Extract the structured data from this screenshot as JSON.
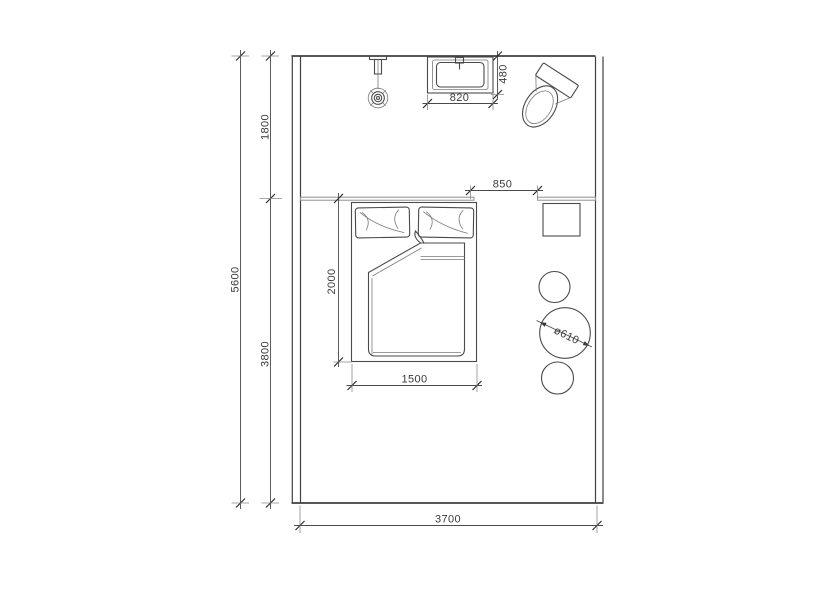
{
  "colors": {
    "line": "#3f3f3f",
    "dimension": "#4a4a4a",
    "partition": "#8f8f8f",
    "background": "#ffffff"
  },
  "dimensions": {
    "total_height": "5600",
    "upper_depth": "1800",
    "lower_depth": "3800",
    "total_width": "3700",
    "opening": "850",
    "sink_width": "820",
    "sink_depth": "480",
    "bed_length": "2000",
    "bed_width": "1500",
    "stool_diameter": "ø610"
  }
}
